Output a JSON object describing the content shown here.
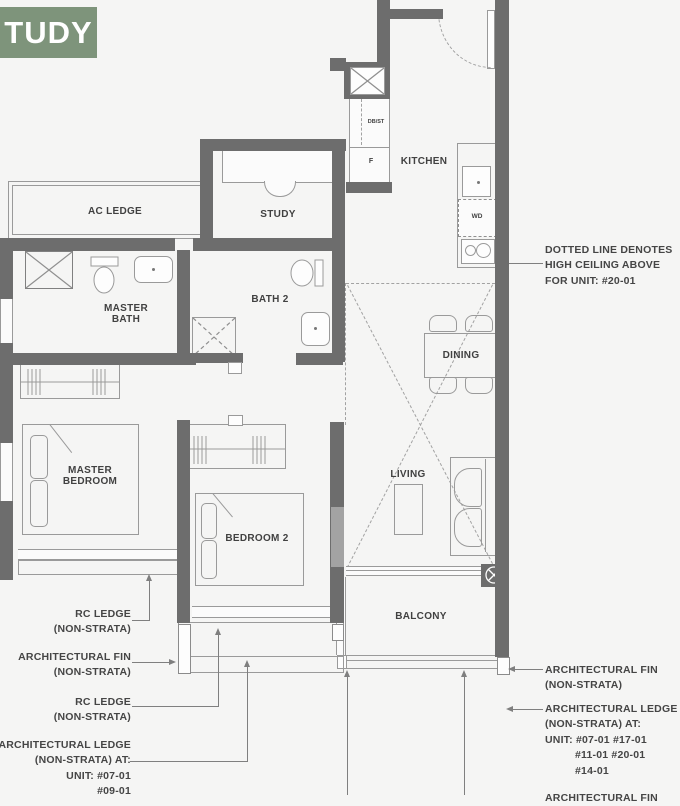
{
  "badge": {
    "label": "TUDY",
    "color": "#7E947B"
  },
  "rooms": {
    "ac_ledge": "AC LEDGE",
    "study": "STUDY",
    "kitchen": "KITCHEN",
    "master_bath": [
      "MASTER",
      "BATH"
    ],
    "bath2": "BATH 2",
    "dining": "DINING",
    "living": "LIVING",
    "master_bedroom": [
      "MASTER",
      "BEDROOM"
    ],
    "bedroom2": "BEDROOM 2",
    "balcony": "BALCONY"
  },
  "fixtures": {
    "db_st": "DB/ST",
    "fridge": "F",
    "washer_dryer": "WD"
  },
  "annotations": {
    "high_ceiling": [
      "DOTTED LINE DENOTES",
      "HIGH CEILING ABOVE",
      "FOR UNIT: #20-01"
    ],
    "rc_ledge_top": [
      "RC LEDGE",
      "(NON-STRATA)"
    ],
    "arch_fin_left": [
      "ARCHITECTURAL FIN",
      "(NON-STRATA)"
    ],
    "rc_ledge_bottom": [
      "RC LEDGE",
      "(NON-STRATA)"
    ],
    "arch_ledge_left": [
      "ARCHITECTURAL LEDGE",
      "(NON-STRATA) AT:",
      "UNIT: #07-01",
      "#09-01"
    ],
    "arch_fin_right": [
      "ARCHITECTURAL FIN",
      "(NON-STRATA)"
    ],
    "arch_ledge_right": [
      "ARCHITECTURAL LEDGE",
      "(NON-STRATA) AT:",
      "UNIT: #07-01  #17-01",
      "#11-01  #20-01",
      "#14-01"
    ],
    "arch_fin_bottom": "ARCHITECTURAL FIN"
  }
}
